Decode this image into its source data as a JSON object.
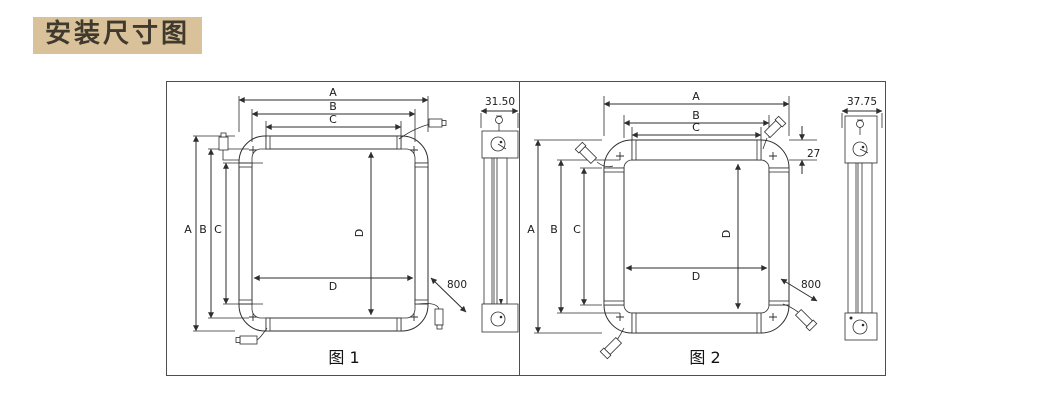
{
  "title": "安装尺寸图",
  "colors": {
    "title_bg": "#d9c29a",
    "title_text": "#40392e",
    "line_color": "#2e2e2e",
    "panel_border": "#4e4e4e",
    "hatch_color": "#9b9b9b"
  },
  "figures": [
    {
      "caption": "图 1",
      "dim_labels": {
        "a": "A",
        "b": "B",
        "c": "C",
        "d": "D"
      },
      "cable_length": "800",
      "profile_depth": "31.50"
    },
    {
      "caption": "图 2",
      "dim_labels": {
        "a": "A",
        "b": "B",
        "c": "C",
        "d": "D"
      },
      "cable_length": "800",
      "profile_depth": "37.75",
      "top_bar_height": "27"
    }
  ]
}
